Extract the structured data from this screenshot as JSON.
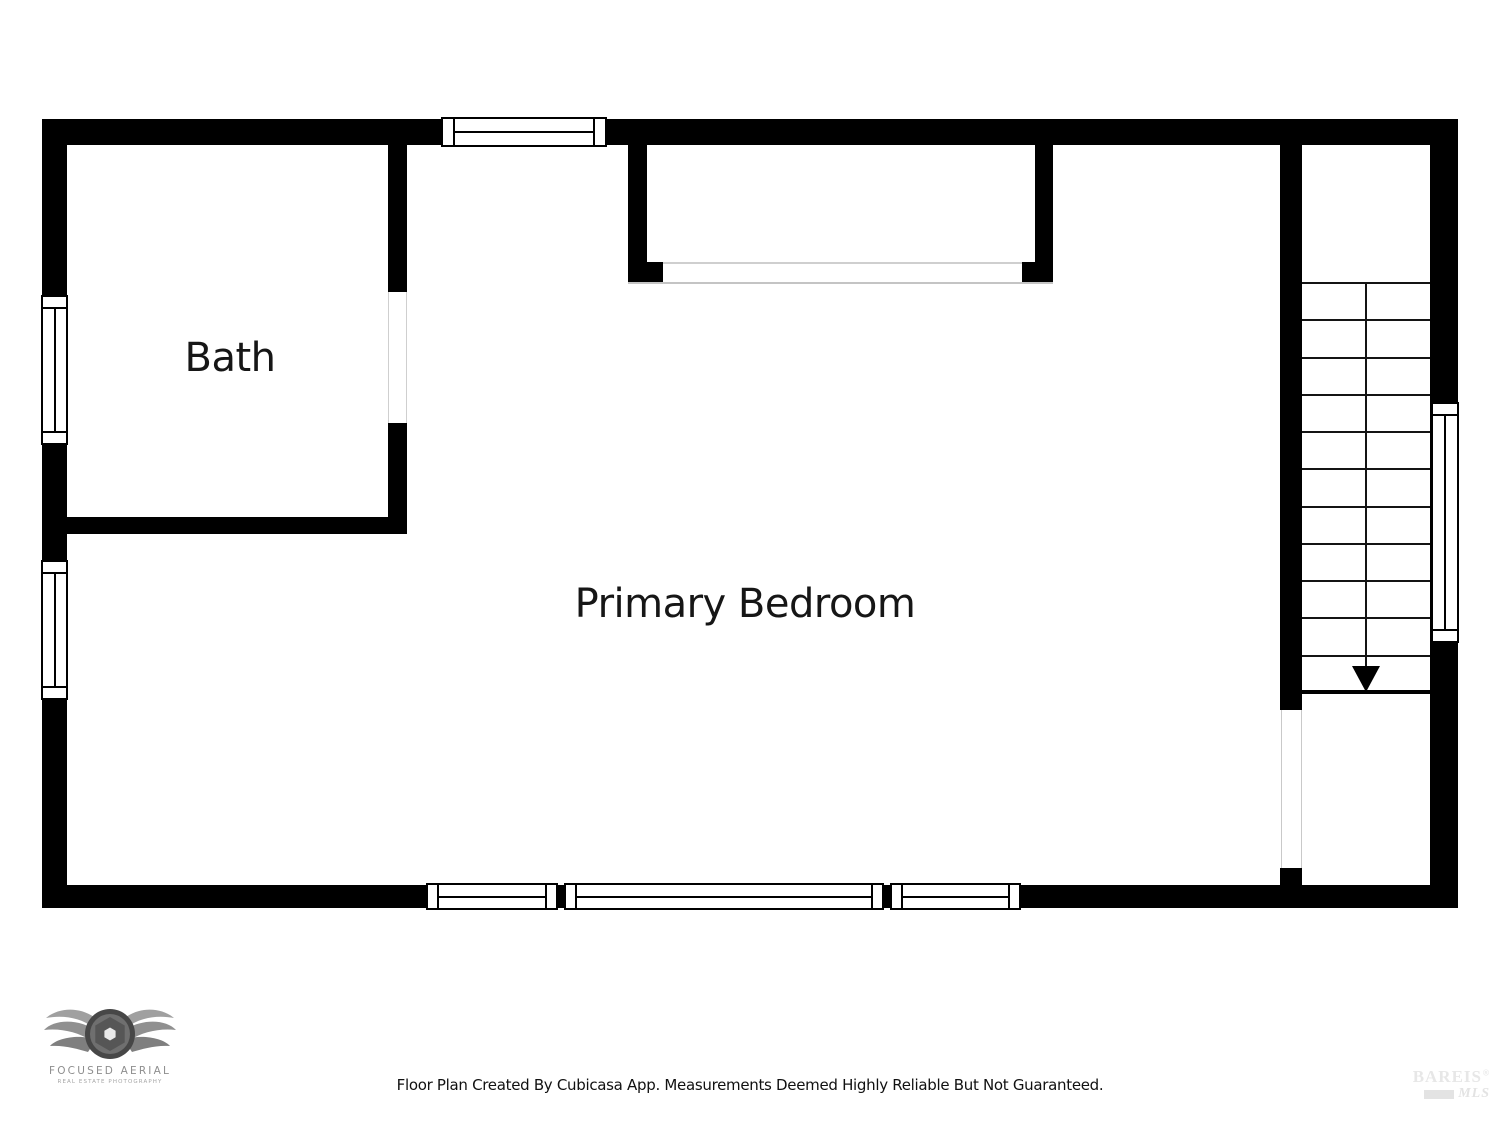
{
  "floorplan": {
    "rooms": [
      {
        "id": "bath",
        "label": "Bath"
      },
      {
        "id": "primary-bedroom",
        "label": "Primary Bedroom"
      }
    ],
    "stairs": {
      "direction": "down",
      "tread_lines": 11,
      "flights": 2
    },
    "wall_color": "#000000",
    "thin_line_color": "#cfcfcf",
    "window_count": 7
  },
  "footer": {
    "disclaimer": "Floor Plan Created By Cubicasa App. Measurements Deemed Highly Reliable But Not Guaranteed."
  },
  "branding": {
    "logo_name": "FOCUSED AERIAL",
    "logo_tagline": "REAL ESTATE PHOTOGRAPHY"
  },
  "watermark": {
    "name": "BAREIS",
    "registered": "®",
    "sub": "MLS"
  }
}
